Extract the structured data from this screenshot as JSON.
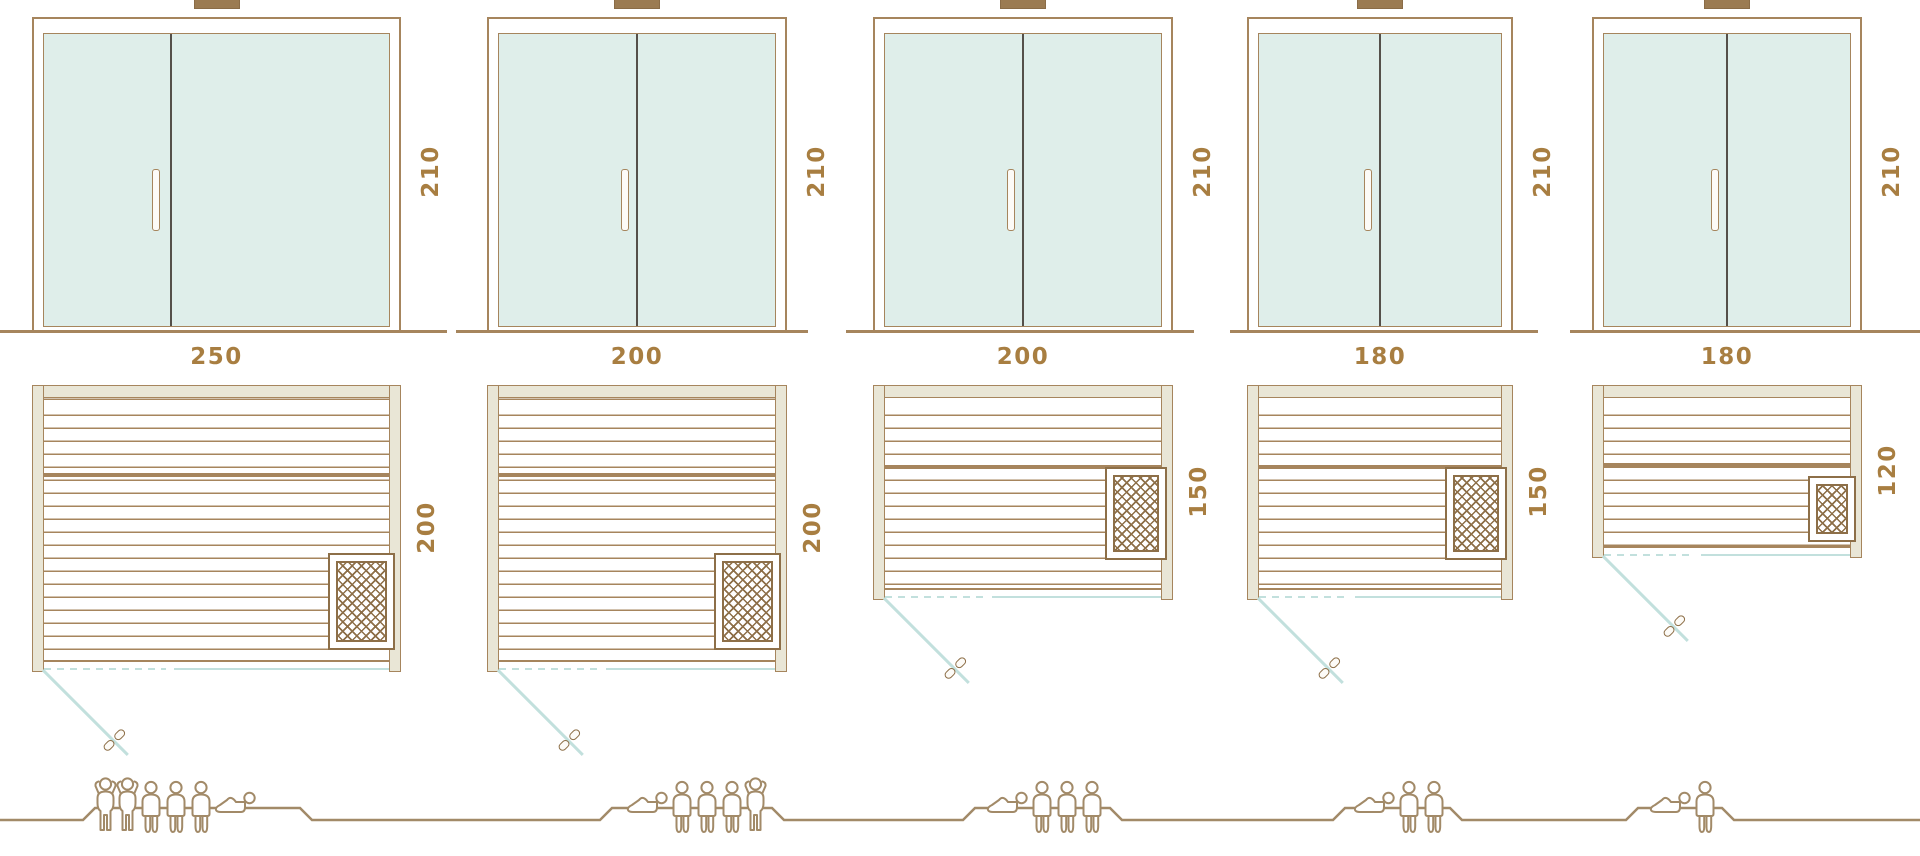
{
  "diagram": {
    "kind": "sauna-size-comparison",
    "units_shown": "cm",
    "colors": {
      "line_tan": "#a6855d",
      "frame_beige": "#e9e6d6",
      "glass_mint": "#dfeeea",
      "swing_teal": "#c2e0dd",
      "label_ochre": "#a87e41",
      "figure_tan": "#a28a68",
      "heater_brown": "#8d6f48"
    },
    "icons": {
      "heater": "crosshatch-square",
      "door_swing": "diagonal-teal-line",
      "door_handle_plan": "double-capsule",
      "person_types": [
        "standing",
        "sitting",
        "lying"
      ]
    }
  },
  "models": [
    {
      "name": "sauna-250x200",
      "door_height_label": "210",
      "width_label": "250",
      "depth_label": "200",
      "capacity": 6,
      "figures": [
        "standing",
        "standing",
        "sitting",
        "sitting",
        "sitting",
        "lying"
      ]
    },
    {
      "name": "sauna-200x200",
      "door_height_label": "210",
      "width_label": "200",
      "depth_label": "200",
      "capacity": 5,
      "figures": [
        "lying",
        "sitting",
        "sitting",
        "sitting",
        "standing"
      ]
    },
    {
      "name": "sauna-200x150",
      "door_height_label": "210",
      "width_label": "200",
      "depth_label": "150",
      "capacity": 4,
      "figures": [
        "lying",
        "sitting",
        "sitting",
        "sitting"
      ]
    },
    {
      "name": "sauna-180x150",
      "door_height_label": "210",
      "width_label": "180",
      "depth_label": "150",
      "capacity": 3,
      "figures": [
        "lying",
        "sitting",
        "sitting"
      ]
    },
    {
      "name": "sauna-180x120",
      "door_height_label": "210",
      "width_label": "180",
      "depth_label": "120",
      "capacity": 2,
      "figures": [
        "lying",
        "sitting"
      ]
    }
  ]
}
